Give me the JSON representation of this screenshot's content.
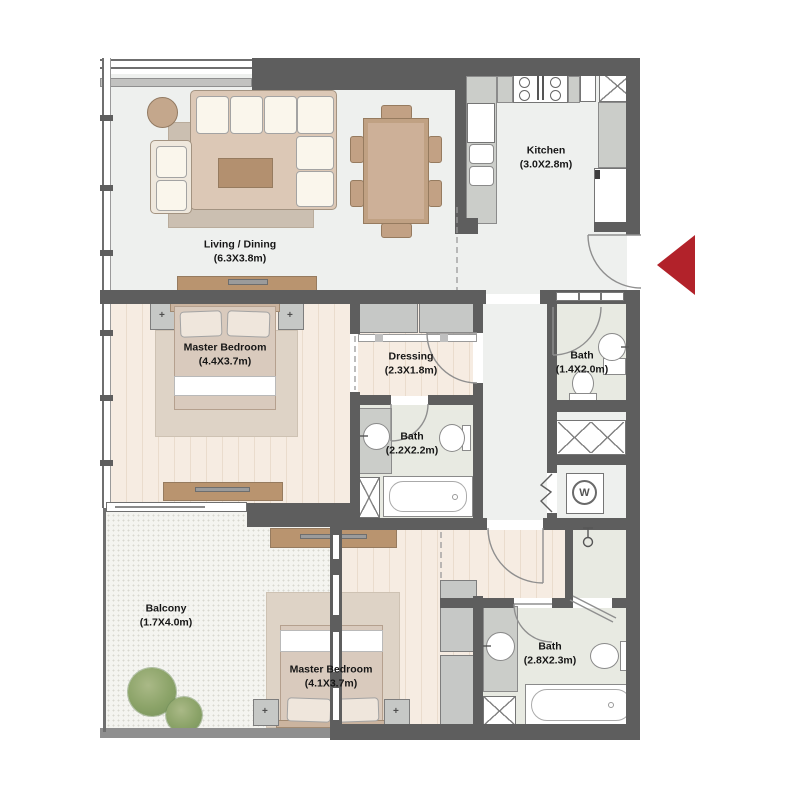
{
  "plan": {
    "type": "apartment-floor-plan",
    "rooms": {
      "living": {
        "name": "Living / Dining",
        "size": "(6.3X3.8m)"
      },
      "kitchen": {
        "name": "Kitchen",
        "size": "(3.0X2.8m)"
      },
      "master1": {
        "name": "Master Bedroom",
        "size": "(4.4X3.7m)"
      },
      "dressing": {
        "name": "Dressing",
        "size": "(2.3X1.8m)"
      },
      "bath_master": {
        "name": "Bath",
        "size": "(2.2X2.2m)"
      },
      "bath_guest": {
        "name": "Bath",
        "size": "(1.4X2.0m)"
      },
      "balcony": {
        "name": "Balcony",
        "size": "(1.7X4.0m)"
      },
      "master2": {
        "name": "Master Bedroom",
        "size": "(4.1X3.7m)"
      },
      "bath_second": {
        "name": "Bath",
        "size": "(2.8X2.3m)"
      }
    },
    "icons": {
      "washer_label": "W",
      "lamp_symbol": "+"
    },
    "colors": {
      "entrance_arrow": "#b2222a",
      "wall": "#5e5e5e",
      "wood_floor": "#f5ebe1",
      "tile_floor": "#e8eae2"
    }
  }
}
